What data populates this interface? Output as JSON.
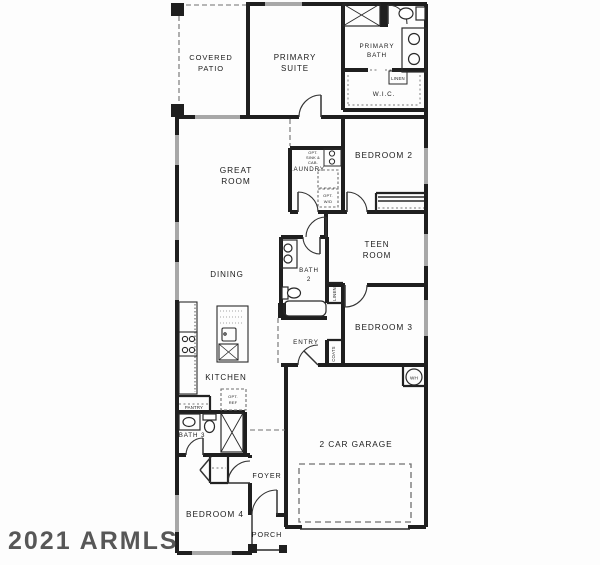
{
  "watermark": "2021 ARMLS",
  "labels": {
    "covered_patio_line1": "COVERED",
    "covered_patio_line2": "PATIO",
    "primary_suite_line1": "PRIMARY",
    "primary_suite_line2": "SUITE",
    "primary_bath_line1": "PRIMARY",
    "primary_bath_line2": "BATH",
    "wic": "W.I.C.",
    "linen_bath": "LINEN",
    "bedroom2": "BEDROOM 2",
    "laundry": "LAUNDRY",
    "opt_sink_line1": "OPT.",
    "opt_sink_line2": "SINK &",
    "opt_sink_line3": "CAB.",
    "opt_wd_line1": "OPT.",
    "opt_wd_line2": "W/D",
    "great_room_line1": "GREAT",
    "great_room_line2": "ROOM",
    "teen_room_line1": "TEEN",
    "teen_room_line2": "ROOM",
    "bath2_line1": "BATH",
    "bath2_line2": "2",
    "linen_hall": "LINEN",
    "dining": "DINING",
    "bedroom3": "BEDROOM 3",
    "entry": "ENTRY",
    "coats": "COATS",
    "kitchen": "KITCHEN",
    "pantry": "PANTRY",
    "opt_ref_line1": "OPT.",
    "opt_ref_line2": "REF",
    "garage": "2 CAR GARAGE",
    "wh": "WH",
    "bath3": "BATH 3",
    "foyer": "FOYER",
    "bedroom4": "BEDROOM 4",
    "porch": "PORCH"
  },
  "colors": {
    "wall": "#1f1f1f",
    "window": "#a8a8a8",
    "dash": "#6f6f6f",
    "fixture": "#2a2a2a",
    "text": "#1c1c1c",
    "watermark": "#414141"
  }
}
